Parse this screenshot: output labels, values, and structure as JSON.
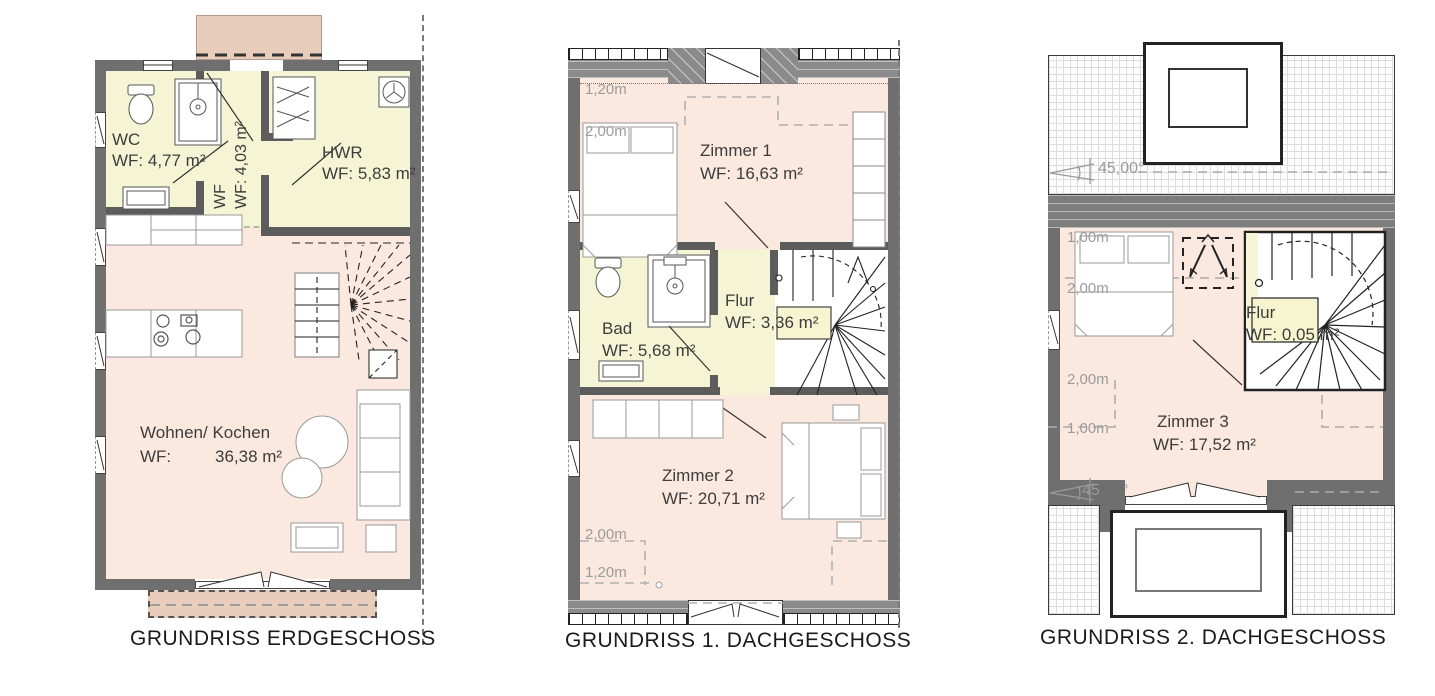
{
  "figure": {
    "type": "architectural-floor-plans",
    "sheet": "3 stacked dwelling levels"
  },
  "colors": {
    "wall": "#6f6f6f",
    "floor_living": "#fbe9e0",
    "floor_wet": "#f5f5d6",
    "terrace": "#e9cdbc",
    "label_text": "#3d3d3d",
    "dimension_text": "#9b9b9b",
    "title_text": "#1b1b1b"
  },
  "plans": [
    {
      "id": "erdgeschoss",
      "title": "GRUNDRISS ERDGESCHOSS",
      "rooms": [
        {
          "name": "WC",
          "area": "WF: 4,77 m²"
        },
        {
          "name": "WF",
          "area": "WF: 4,03 m²"
        },
        {
          "name": "HWR",
          "area": "WF: 5,83 m²"
        },
        {
          "name": "Wohnen/ Kochen",
          "area_label": "WF:",
          "area_value": "36,38 m²"
        }
      ]
    },
    {
      "id": "dachgeschoss-1",
      "title": "GRUNDRISS 1. DACHGESCHOSS",
      "rooms": [
        {
          "name": "Zimmer 1",
          "area": "WF: 16,63 m²"
        },
        {
          "name": "Bad",
          "area": "WF: 5,68 m²"
        },
        {
          "name": "Flur",
          "area": "WF: 3,36 m²"
        },
        {
          "name": "Zimmer 2",
          "area": "WF: 20,71 m²"
        }
      ],
      "dimensions": {
        "top": [
          "1,20m",
          "2,00m"
        ],
        "bottom": [
          "2,00m",
          "1,20m"
        ]
      }
    },
    {
      "id": "dachgeschoss-2",
      "title": "GRUNDRISS 2. DACHGESCHOSS",
      "rooms": [
        {
          "name": "Flur",
          "area": "WF: 0,05 m²"
        },
        {
          "name": "Zimmer 3",
          "area": "WF: 17,52 m²"
        }
      ],
      "dimensions": [
        "1,00m",
        "2,00m",
        "2,00m",
        "1,00m"
      ],
      "roof_angles": [
        "45,00°",
        "45,00°"
      ]
    }
  ]
}
